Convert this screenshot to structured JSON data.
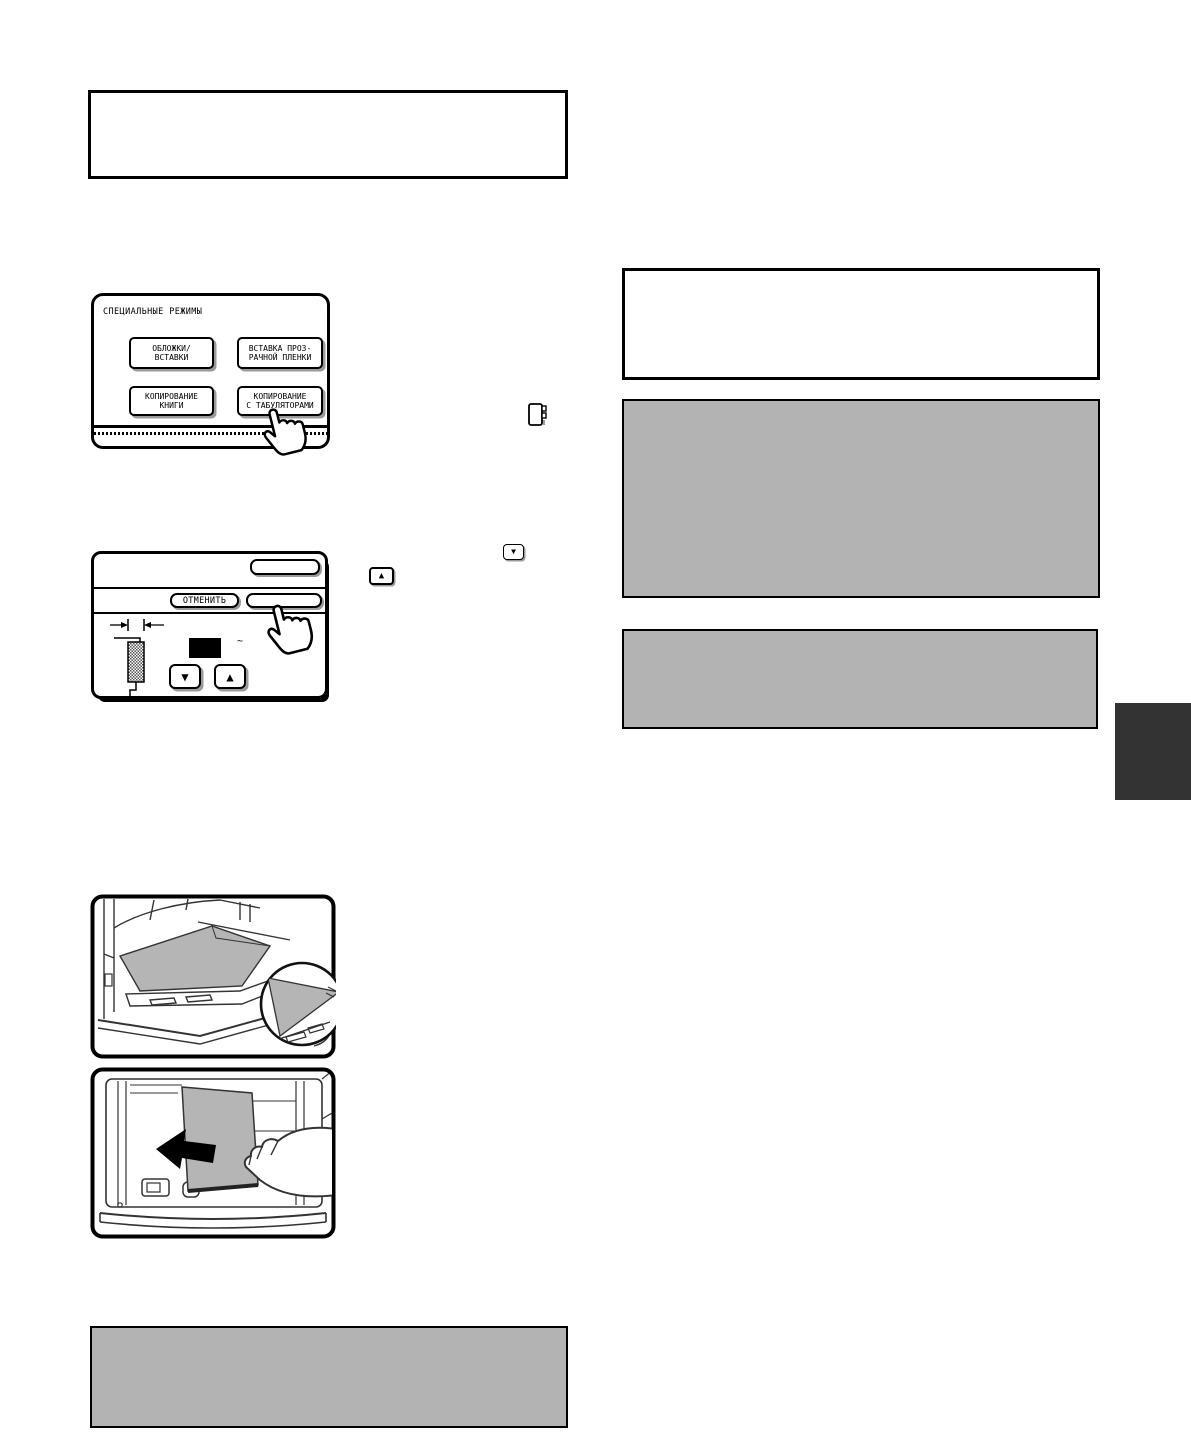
{
  "colors": {
    "gray_box_fill": "#b3b3b3",
    "dark_side_tab": "#333333",
    "paper_gray": "#b5b5b5",
    "button_shadow": "#9a9a9a"
  },
  "panel_special_modes": {
    "title": "СПЕЦИАЛЬНЫЕ РЕЖИМЫ",
    "buttons": [
      {
        "line1": "ОБЛОЖКИ/",
        "line2": "ВСТАВКИ"
      },
      {
        "line1": "ВСТАВКА ПРОЗ-",
        "line2": "РАЧНОЙ ПЛЕНКИ"
      },
      {
        "line1": "КОПИРОВАНИЕ",
        "line2": "КНИГИ"
      },
      {
        "line1": "КОПИРОВАНИЕ",
        "line2": "С ТАБУЛЯТОРАМИ"
      }
    ]
  },
  "panel_tab_width": {
    "cancel_label": "ОТМЕНИТЬ",
    "top_button_label": "",
    "ok_button_label": "",
    "tilde": "~"
  },
  "icons": {
    "down_triangle": "▼",
    "up_triangle": "▲"
  }
}
